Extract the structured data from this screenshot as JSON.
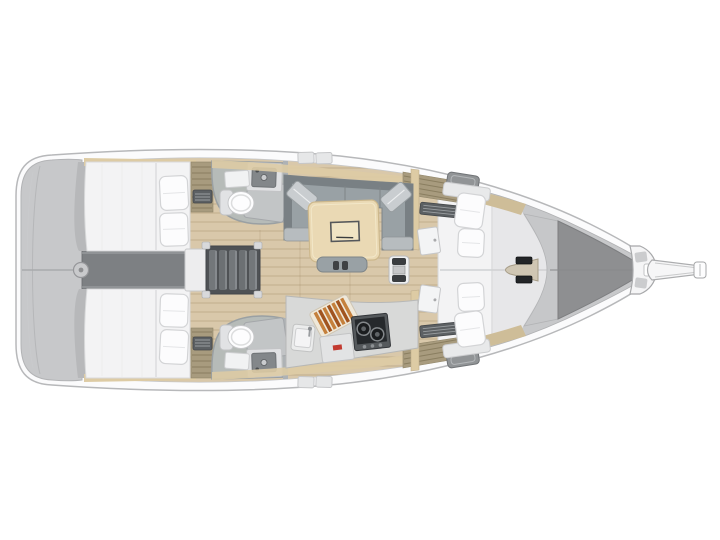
{
  "meta": {
    "description": "Top-down interior layout plan of a sailing yacht, bow pointing right, rendered on a white background",
    "orientation": "bow-right",
    "canvas": {
      "width": 720,
      "height": 540
    }
  },
  "colors": {
    "background": "#ffffff",
    "hull": "#fbfbfc",
    "hullStroke": "#b7b8ba",
    "deck": "#c7c8ca",
    "engine": "#7d8083",
    "floor": "#d9c8aa",
    "trim": "#ddcba4",
    "trimForward": "#cebd98",
    "louver": "#a89b7e",
    "berth": "#f3f3f4",
    "pillow": "#fcfcfd",
    "headFloor": "#b6bbb8",
    "fixtureWhite": "#fdfdfe",
    "basin": "#83878a",
    "showerPanel": "#c4c6c8",
    "settee": "#99a1a5",
    "setteeDark": "#798084",
    "cushion": "#c9cdd0",
    "table": "#ead9b4",
    "tableRecess": "#f0e4c4",
    "stairsHousing": "#4f5255",
    "tread": "#73777a",
    "counter": "#d8d9d8",
    "stoveFrame": "#55595c",
    "stovePanel": "#26292c",
    "board": "#efe8d9",
    "boardStripeA": "#c5803c",
    "boardStripeB": "#a1541f",
    "accentRed": "#c23a30",
    "foredeck": "#c7c8ca",
    "anchorLocker": "#8e8f91",
    "windlass": "#cfc6b3",
    "bowsprit": "#f6f6f7"
  },
  "plan": {
    "zones": {
      "stern_platform": {
        "name": "stern platform",
        "fittings": [
          "transom hinge circle",
          "centerline seam"
        ]
      },
      "aft_cabin_port": {
        "name": "aft cabin port",
        "berth": "double berth",
        "pillow_count": 2,
        "features": [
          "louvered locker",
          "vent grille"
        ]
      },
      "aft_cabin_starboard": {
        "name": "aft cabin starboard",
        "berth": "double berth",
        "pillow_count": 2,
        "features": [
          "louvered locker",
          "vent grille"
        ]
      },
      "engine_compartment": {
        "name": "engine compartment"
      },
      "companionway": {
        "name": "companionway steps",
        "step_count": 5
      },
      "head_port": {
        "name": "head port",
        "fixtures": [
          "toilet",
          "sink basin",
          "vanity panel",
          "shower door"
        ]
      },
      "head_starboard": {
        "name": "head starboard",
        "fixtures": [
          "toilet",
          "sink basin",
          "vanity panel",
          "shower door"
        ]
      },
      "salon": {
        "name": "salon",
        "settee": "U-shaped settee",
        "corner_cushion_count": 2,
        "table": "salon table with recessed tray",
        "bench": "centerline bench"
      },
      "galley": {
        "name": "galley",
        "equipment": [
          "two-burner stove",
          "sink",
          "striped cutting board",
          "locker with red badge"
        ]
      },
      "mast_step": {
        "name": "mast step fitting"
      },
      "forward_cabin": {
        "name": "forward cabin",
        "berth": "V-berth",
        "pillow_count": 4,
        "door_count": 2
      },
      "foredeck": {
        "name": "foredeck",
        "features": [
          "windlass",
          "anchor locker hatch"
        ]
      },
      "bow": {
        "name": "bow",
        "features": [
          "stem fitting",
          "bowsprit",
          "anchor roller"
        ]
      }
    }
  }
}
